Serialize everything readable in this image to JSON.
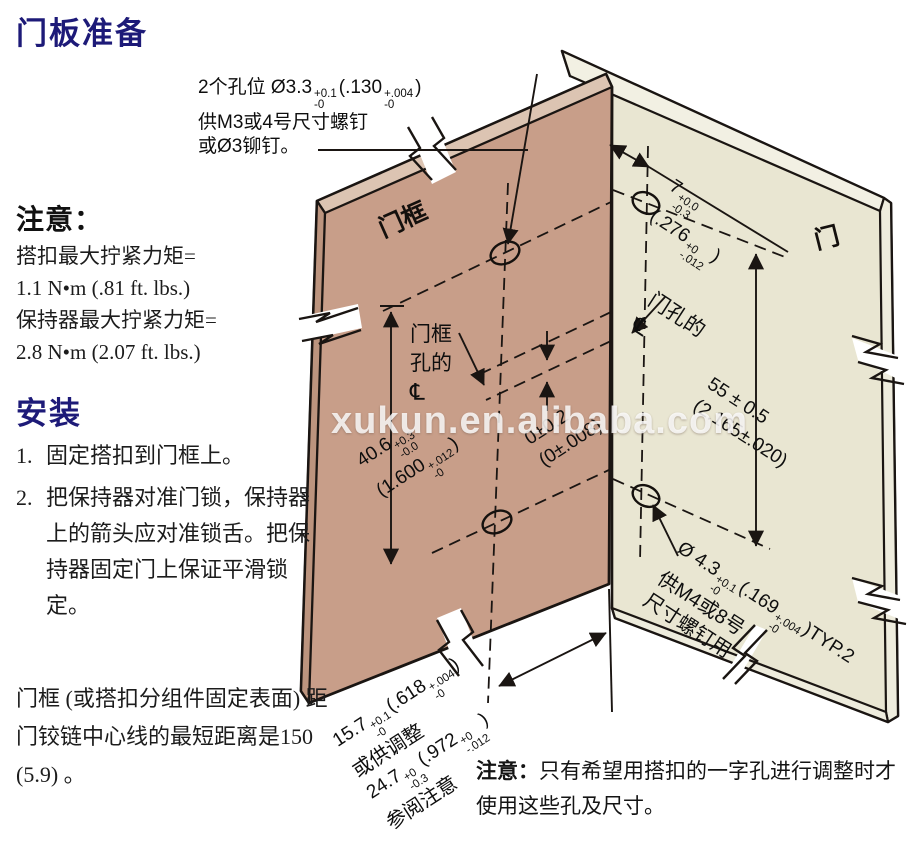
{
  "colors": {
    "navy": "#1d1a78",
    "line": "#1a1512",
    "panel_tan": "#c89e89",
    "panel_tan_top": "#dcc4b2",
    "panel_tan_side": "#bc947e",
    "panel_cream": "#e9e6d2",
    "panel_cream_top": "#f2f0e3",
    "panel_cream_side": "#eeecdd"
  },
  "left_column": {
    "title": "门板准备",
    "note_heading": "注意：",
    "note_lines": [
      "搭扣最大拧紧力矩=",
      "1.1 N•m (.81 ft. lbs.)",
      "保持器最大拧紧力矩=",
      "2.8 N•m (2.07 ft. lbs.)"
    ],
    "install_heading": "安装",
    "steps": [
      {
        "num": "1.",
        "text": "固定搭扣到门框上。"
      },
      {
        "num": "2.",
        "text": "把保持器对准门锁，保持器上的箭头应对准锁舌。把保持器固定门上保证平滑锁定。"
      }
    ],
    "bottom_note": "门框 (或搭扣分组件固定表面) 距门铰链中心线的最短距离是150 (5.9) 。"
  },
  "top_annotation": {
    "line1_pre": "2个孔位 Ø3.3",
    "tol1_sup": "+0.1",
    "tol1_sub": "-0",
    "line1_mid": "(.130",
    "tol2_sup": "+.004",
    "tol2_sub": "-0",
    "line1_end": ")",
    "line2": "供M3或4号尺寸螺钉",
    "line3": "或Ø3铆钉。"
  },
  "diagram": {
    "panel_left_label": "门框",
    "panel_right_label": "门",
    "frame_cl": {
      "l1": "门框",
      "l2": "孔的",
      "sym": "℄"
    },
    "door_cl": {
      "l1": "门孔的",
      "sym": "℄"
    },
    "dim_7": {
      "main": "7",
      "sup": "+0.0",
      "sub": "-0.3",
      "paren": "(.276",
      "psup": "+0",
      "psub": "-.012",
      "close": ")"
    },
    "dim_55": {
      "l1": "55 ± 0.5",
      "l2": "(2.165±.020)"
    },
    "dim_40": {
      "main": "40.6",
      "sup": "+0.3",
      "sub": "-0.0",
      "paren": "(1.600",
      "psup": "+.012",
      "psub": "-0",
      "close": ")"
    },
    "dim_0": {
      "l1": "0±0.2",
      "l2": "(0±.008)"
    },
    "dim_43": {
      "main": "Ø 4.3",
      "sup": "+0.1",
      "sub": "-0",
      "paren": "(.169",
      "psup": "+.004",
      "psub": "-0",
      "close": ")TYP.2",
      "l2": "供M4或8号",
      "l3": "尺寸螺钉用"
    },
    "dim_bottom": {
      "m1": "15.7",
      "s1": "+0.1",
      "b1": "-0",
      "p1": "(.618",
      "ps1": "+.004",
      "pb1": "-0",
      "c1": ")",
      "l2": "或供调整",
      "m3": "24.7",
      "s3": "+0",
      "b3": "-0.3",
      "p3": "(.972",
      "ps3": "+0",
      "pb3": "-.012",
      "c3": ")",
      "l4": "参阅注意"
    }
  },
  "bottom_note": {
    "bold": "注意：",
    "text": "只有希望用搭扣的一字孔进行调整时才使用这些孔及尺寸。"
  },
  "watermark": "xukun.en.alibaba.com"
}
